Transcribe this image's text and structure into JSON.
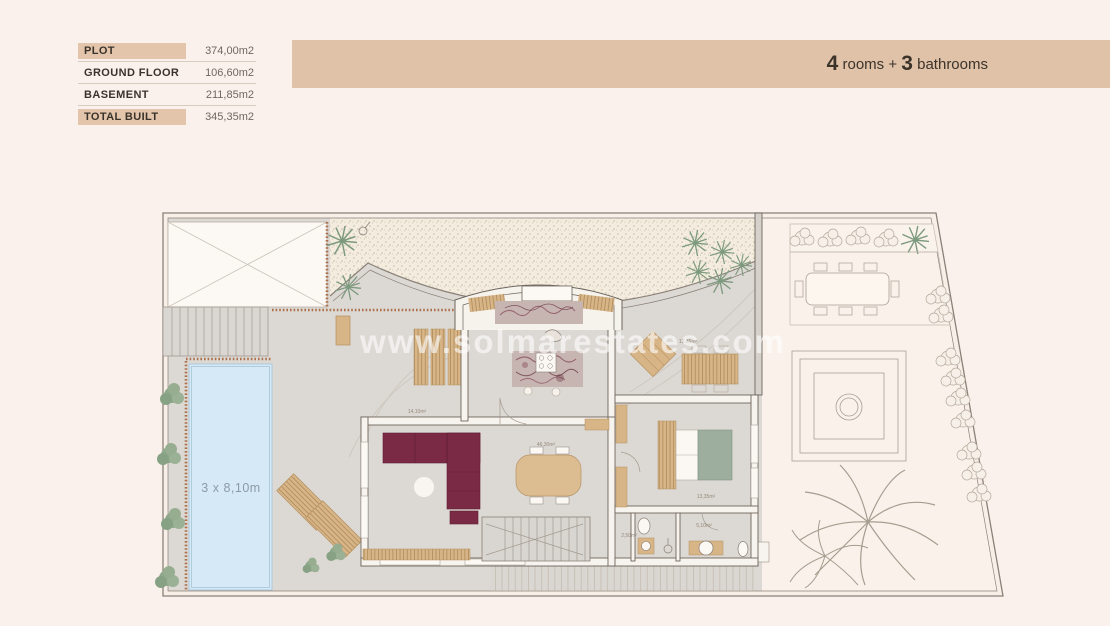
{
  "stats_table": {
    "rows": [
      {
        "label": "PLOT",
        "value": "374,00m2",
        "highlighted": true
      },
      {
        "label": "GROUND FLOOR",
        "value": "106,60m2",
        "highlighted": false
      },
      {
        "label": "BASEMENT",
        "value": "211,85m2",
        "highlighted": false
      },
      {
        "label": "TOTAL BUILT",
        "value": "345,35m2",
        "highlighted": true
      }
    ]
  },
  "header": {
    "rooms_count": "4",
    "rooms_text": " rooms + ",
    "bathrooms_count": "3",
    "bathrooms_text": " bathrooms",
    "floor_number": "3"
  },
  "floor_plan": {
    "watermark": "www.solmarestates.com",
    "pool": {
      "label": "3 x 8,10m"
    },
    "room_labels": {
      "terrace": "14,10m²",
      "living": "46,30m²",
      "porch": "12,85m²",
      "bedroom": "13,35m²",
      "bath_small": "2,50m²",
      "bath_main": "5,10m²"
    }
  },
  "colors": {
    "band_tan": "#e0c2a9",
    "highlight_tan": "#e3c5ab",
    "terrace_gray": "#dcd8d3",
    "gravel": "#f3ecdf",
    "pool_blue": "#d5e9f6",
    "sofa_burgundy": "#7a2a45",
    "bed_sage": "#9dae9f",
    "wood": "#d8b587",
    "plant_green": "#8fa88b",
    "number_dark": "#28231e"
  }
}
